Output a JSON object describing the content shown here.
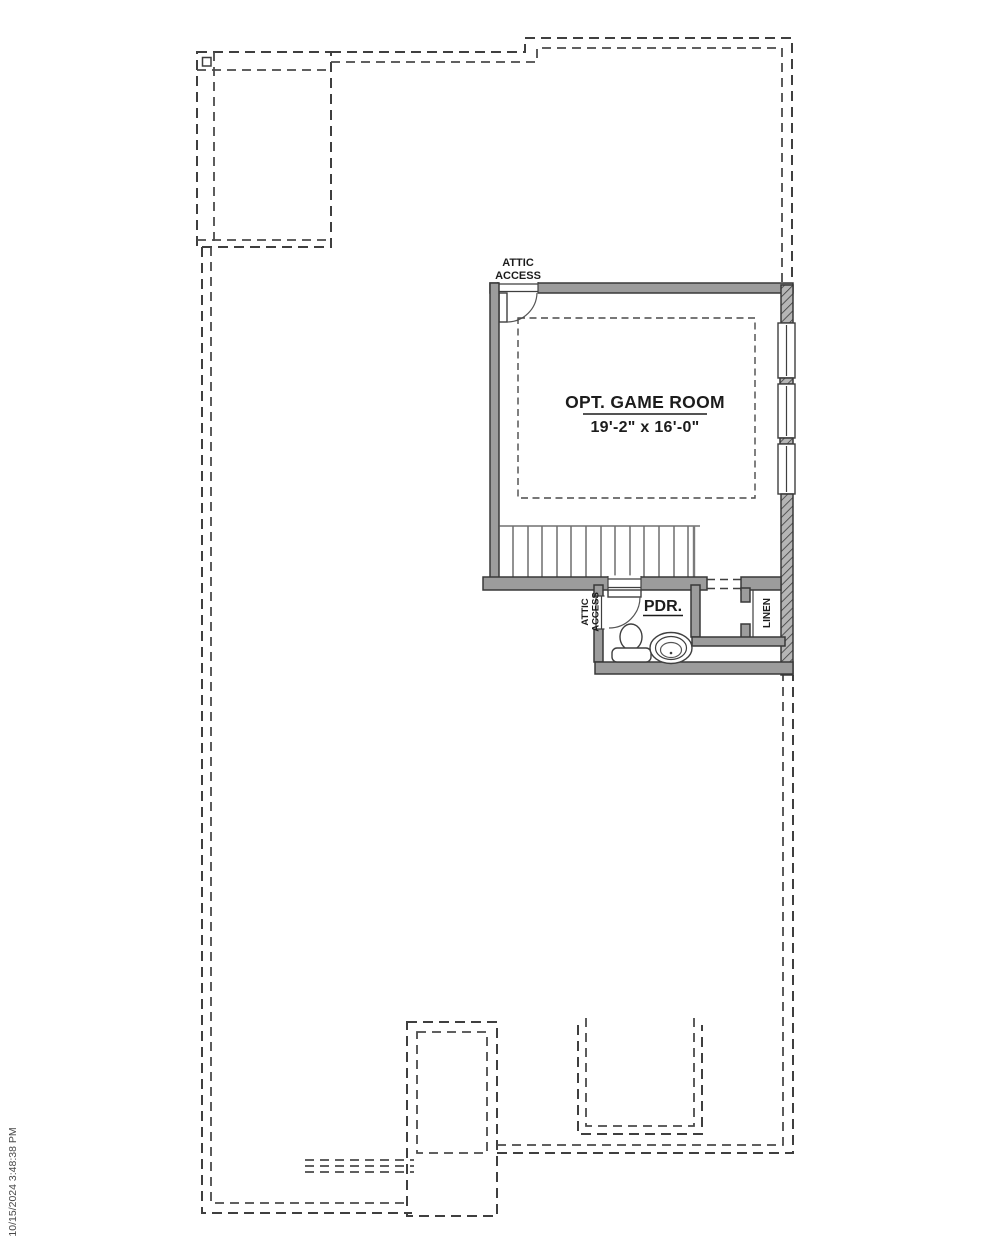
{
  "document": {
    "timestamp": "10/15/2024 3:48:38 PM"
  },
  "labels": {
    "game_room": {
      "name": "OPT. GAME ROOM",
      "dimensions": "19'-2\" x 16'-0\""
    },
    "powder_room": {
      "name": "PDR."
    },
    "linen_closet": {
      "name": "LINEN"
    },
    "attic_access_game_room": {
      "line1": "ATTIC",
      "line2": "ACCESS"
    },
    "attic_access_powder": {
      "line1": "ATTIC",
      "line2": "ACCESS"
    }
  },
  "colors": {
    "background": "#ffffff",
    "wall_fill": "#9c9c9c",
    "line": "#3f3f3f",
    "text": "#1c1c1c"
  }
}
